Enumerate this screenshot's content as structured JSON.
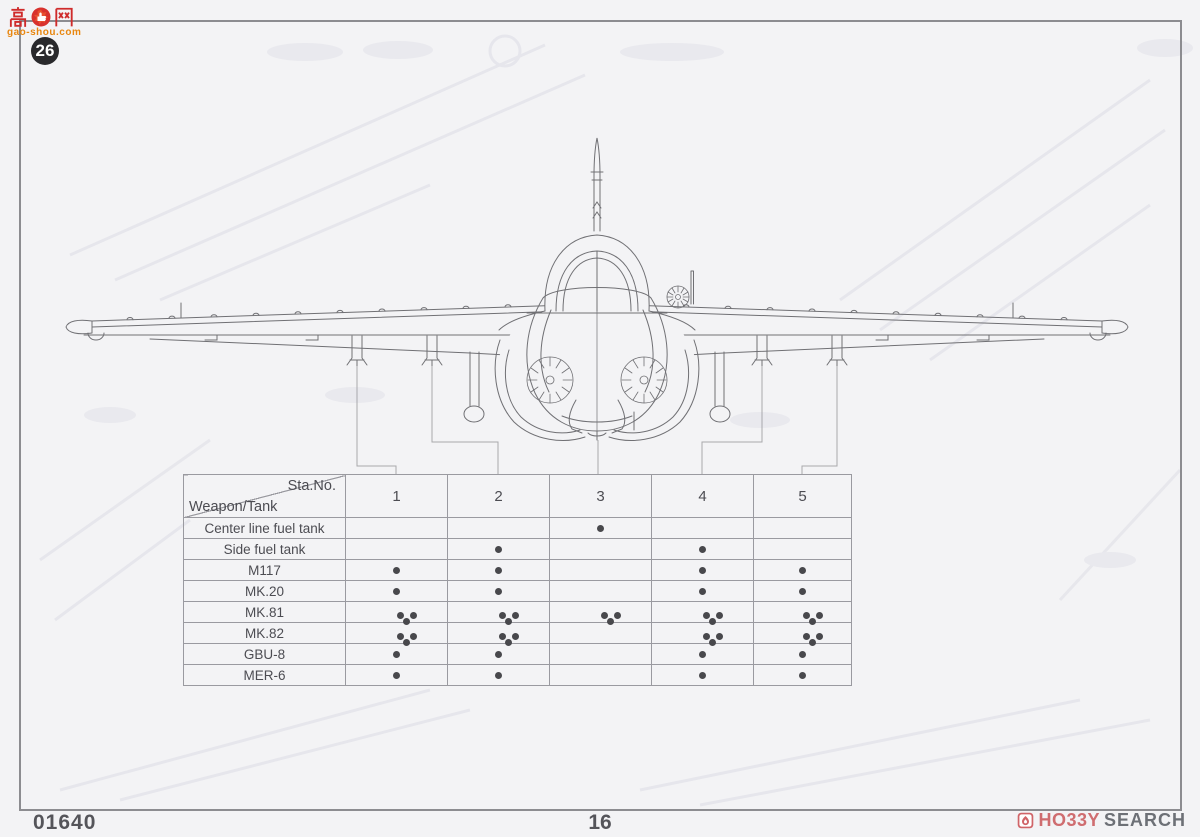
{
  "watermark": {
    "char_left": "高",
    "char_right": "网",
    "domain_text": "gao-shou.com"
  },
  "page_badge": "26",
  "table": {
    "corner": {
      "top": "Sta.No.",
      "bottom": "Weapon/Tank"
    },
    "station_columns": [
      "1",
      "2",
      "3",
      "4",
      "5"
    ],
    "rows": [
      {
        "label": "Center line fuel tank",
        "stations": [
          0,
          0,
          1,
          0,
          0
        ]
      },
      {
        "label": "Side fuel tank",
        "stations": [
          0,
          1,
          0,
          1,
          0
        ]
      },
      {
        "label": "M117",
        "stations": [
          1,
          1,
          0,
          1,
          1
        ]
      },
      {
        "label": "MK.20",
        "stations": [
          1,
          1,
          0,
          1,
          1
        ]
      },
      {
        "label": "MK.81",
        "stations": [
          3,
          3,
          3,
          3,
          3
        ]
      },
      {
        "label": "MK.82",
        "stations": [
          3,
          3,
          0,
          3,
          3
        ]
      },
      {
        "label": "GBU-8",
        "stations": [
          1,
          1,
          0,
          1,
          1
        ]
      },
      {
        "label": "MER-6",
        "stations": [
          1,
          1,
          0,
          1,
          1
        ]
      }
    ]
  },
  "footer": {
    "kit_number": "01640",
    "page_number": "16",
    "shop_logo": {
      "hobby": "HO33Y",
      "search": "SEARCH"
    }
  },
  "colors": {
    "page_bg": "#f3f3f5",
    "frame": "#8c8c90",
    "lineart": "#707074",
    "table_border": "#9a9aa0",
    "dot": "#48484c",
    "watermark_red": "#cf2b2b",
    "watermark_orange": "#e8860f",
    "badge_bg": "#29292c",
    "shop_pink": "#cf6d70",
    "shop_gray": "#6d7076"
  }
}
